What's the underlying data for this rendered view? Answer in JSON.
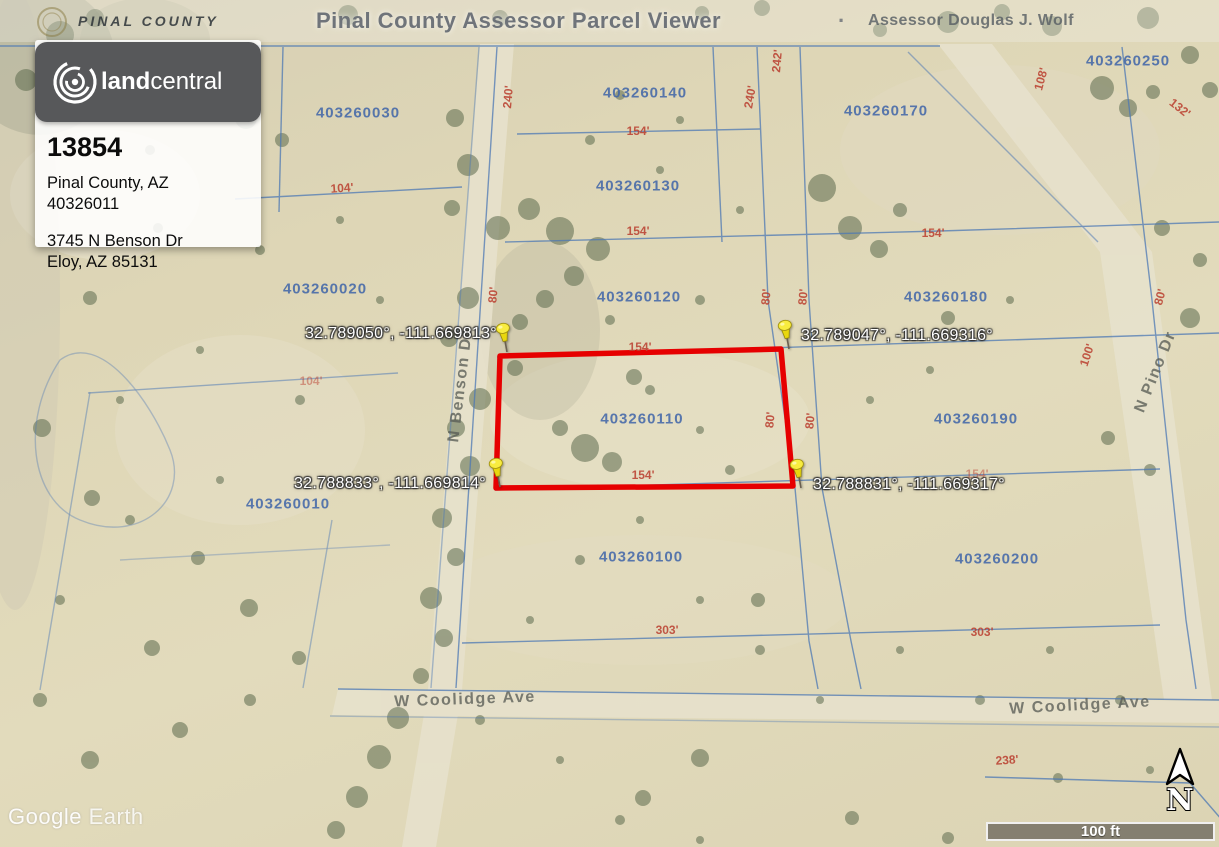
{
  "banner": {
    "county_label": "PINAL COUNTY",
    "title": "Pinal County Assessor Parcel Viewer",
    "separator": "·",
    "assessor": "Assessor Douglas J. Wolf"
  },
  "card": {
    "brand_bold": "land",
    "brand_light": "central",
    "listing_id": "13854",
    "location": "Pinal County, AZ",
    "parcel_number": "40326011",
    "address_line1": "3745 N Benson Dr",
    "address_line2": "Eloy, AZ 85131"
  },
  "map": {
    "watermark_bold": "Google",
    "watermark_light": "Earth",
    "scale_label": "100 ft",
    "north_label": "N",
    "colors": {
      "selected_outline": "#e60000",
      "parcel_label": "#3e64a8",
      "dimension_label": "#bb4232",
      "pin": "#f2e000",
      "boundary_line": "#4d78b5"
    },
    "selected_parcel_outline": [
      [
        500,
        356
      ],
      [
        781,
        349
      ],
      [
        793,
        486
      ],
      [
        496,
        488
      ]
    ],
    "pins": [
      [
        507,
        352
      ],
      [
        789,
        349
      ],
      [
        500,
        487
      ],
      [
        801,
        488
      ]
    ],
    "parcel_labels": [
      {
        "text": "403260030",
        "x": 358,
        "y": 113
      },
      {
        "text": "403260140",
        "x": 645,
        "y": 93
      },
      {
        "text": "403260250",
        "x": 1128,
        "y": 61
      },
      {
        "text": "403260170",
        "x": 886,
        "y": 111
      },
      {
        "text": "403260130",
        "x": 638,
        "y": 186
      },
      {
        "text": "403260020",
        "x": 325,
        "y": 289
      },
      {
        "text": "403260120",
        "x": 639,
        "y": 297
      },
      {
        "text": "403260180",
        "x": 946,
        "y": 297
      },
      {
        "text": "403260110",
        "x": 642,
        "y": 419
      },
      {
        "text": "403260190",
        "x": 976,
        "y": 419
      },
      {
        "text": "403260010",
        "x": 288,
        "y": 504
      },
      {
        "text": "403260100",
        "x": 641,
        "y": 557
      },
      {
        "text": "403260200",
        "x": 997,
        "y": 559
      }
    ],
    "dimension_labels": [
      {
        "text": "104'",
        "x": 342,
        "y": 188,
        "rot": -4
      },
      {
        "text": "154'",
        "x": 638,
        "y": 131
      },
      {
        "text": "154'",
        "x": 638,
        "y": 231
      },
      {
        "text": "154'",
        "x": 933,
        "y": 233
      },
      {
        "text": "154'",
        "x": 640,
        "y": 347
      },
      {
        "text": "154'",
        "x": 643,
        "y": 475
      },
      {
        "text": "154'",
        "x": 977,
        "y": 474,
        "faint": true
      },
      {
        "text": "104'",
        "x": 311,
        "y": 381,
        "faint": true
      },
      {
        "text": "303'",
        "x": 667,
        "y": 630
      },
      {
        "text": "303'",
        "x": 982,
        "y": 632
      },
      {
        "text": "238'",
        "x": 1007,
        "y": 760,
        "rot": -4
      },
      {
        "text": "240'",
        "x": 508,
        "y": 97,
        "rot": -85
      },
      {
        "text": "242'",
        "x": 777,
        "y": 61,
        "rot": -85
      },
      {
        "text": "240'",
        "x": 750,
        "y": 97,
        "rot": -80
      },
      {
        "text": "80'",
        "x": 493,
        "y": 295,
        "rot": -85
      },
      {
        "text": "80'",
        "x": 766,
        "y": 297,
        "rot": -85
      },
      {
        "text": "80'",
        "x": 803,
        "y": 297,
        "rot": -85
      },
      {
        "text": "80'",
        "x": 770,
        "y": 420,
        "rot": -85
      },
      {
        "text": "80'",
        "x": 810,
        "y": 421,
        "rot": -85
      },
      {
        "text": "80'",
        "x": 1160,
        "y": 297,
        "rot": -75
      },
      {
        "text": "100'",
        "x": 1087,
        "y": 355,
        "rot": -72
      },
      {
        "text": "108'",
        "x": 1041,
        "y": 79,
        "rot": -75
      },
      {
        "text": "132'",
        "x": 1180,
        "y": 108,
        "rot": 38
      }
    ],
    "street_labels": [
      {
        "text": "W Coolidge Ave",
        "x": 465,
        "y": 700,
        "rot": -2
      },
      {
        "text": "W Coolidge Ave",
        "x": 1080,
        "y": 706,
        "rot": -3
      },
      {
        "text": "N Benson Dr",
        "x": 461,
        "y": 386,
        "rot": -83
      },
      {
        "text": "N Pino Dr",
        "x": 1156,
        "y": 372,
        "rot": -68
      }
    ],
    "coordinate_labels": [
      {
        "text": "32.789050°, -111.669813°",
        "x": 497,
        "y": 334,
        "anchor": "end"
      },
      {
        "text": "32.789047°, -111.669316°",
        "x": 801,
        "y": 336,
        "anchor": "start"
      },
      {
        "text": "32.788833°, -111.669814°",
        "x": 486,
        "y": 484,
        "anchor": "end"
      },
      {
        "text": "32.788831°, -111.669317°",
        "x": 813,
        "y": 485,
        "anchor": "start"
      }
    ]
  }
}
